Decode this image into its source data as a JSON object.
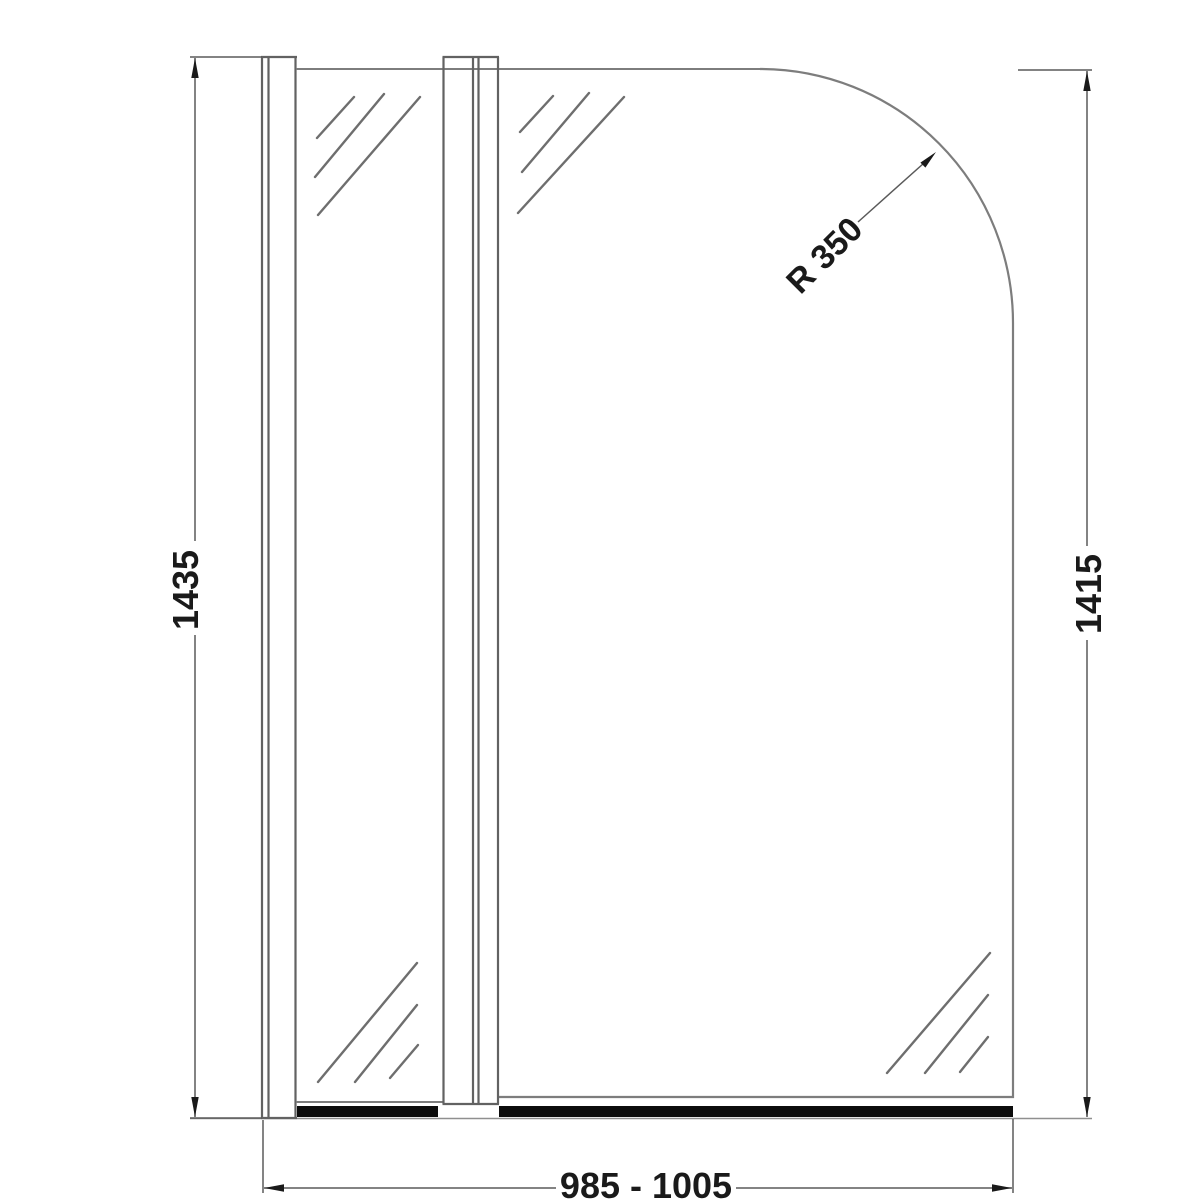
{
  "drawing": {
    "title": "bath-shower-screen-front-elevation",
    "labels": {
      "height_left": "1435",
      "height_right": "1415",
      "width_range": "985 - 1005",
      "corner_radius": "R 350"
    },
    "colors": {
      "background": "#ffffff",
      "glass_outline": "#7d7d7d",
      "profile_line": "#606060",
      "hatch_line": "#6e6e6e",
      "dimension_line": "#5a5a5a",
      "arrow_and_text": "#1a1a1a",
      "bottom_seal": "#0c0c0c"
    }
  }
}
